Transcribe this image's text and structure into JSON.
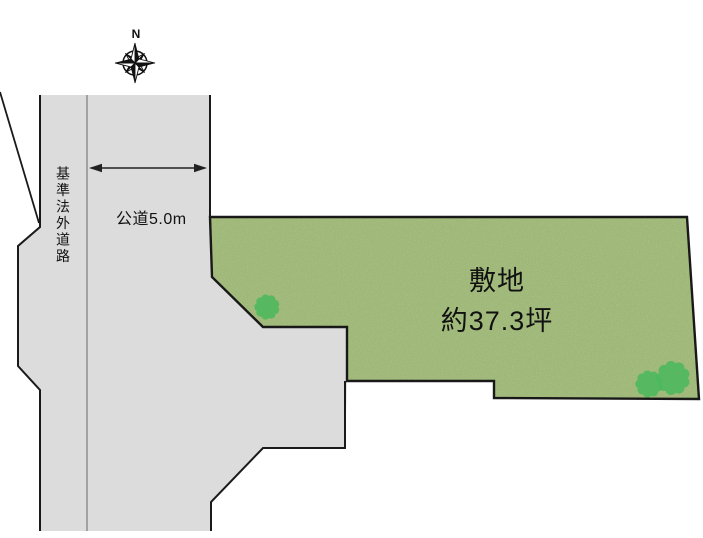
{
  "diagram": {
    "compass": {
      "north_label": "N"
    },
    "roads": {
      "outside_standard_road_label": "基準法外道路",
      "public_road_label": "公道5.0m"
    },
    "plot": {
      "name_label": "敷地",
      "area_label": "約37.3坪"
    },
    "colors": {
      "background": "#ffffff",
      "road_fill": "#dcdcdc",
      "road_outline": "#1a1a1a",
      "lane_divider": "#8f8f8f",
      "plot_fill": "#b5d18b",
      "plot_outline": "#1a1a1a",
      "tree_fill": "#49b95c",
      "dimension_arrow": "#222222",
      "text": "#111111"
    },
    "icons": {
      "compass_rose": "8-point star with ring",
      "tree": "scalloped circle canopy",
      "dimension_arrow": "double-headed horizontal arrow"
    }
  }
}
